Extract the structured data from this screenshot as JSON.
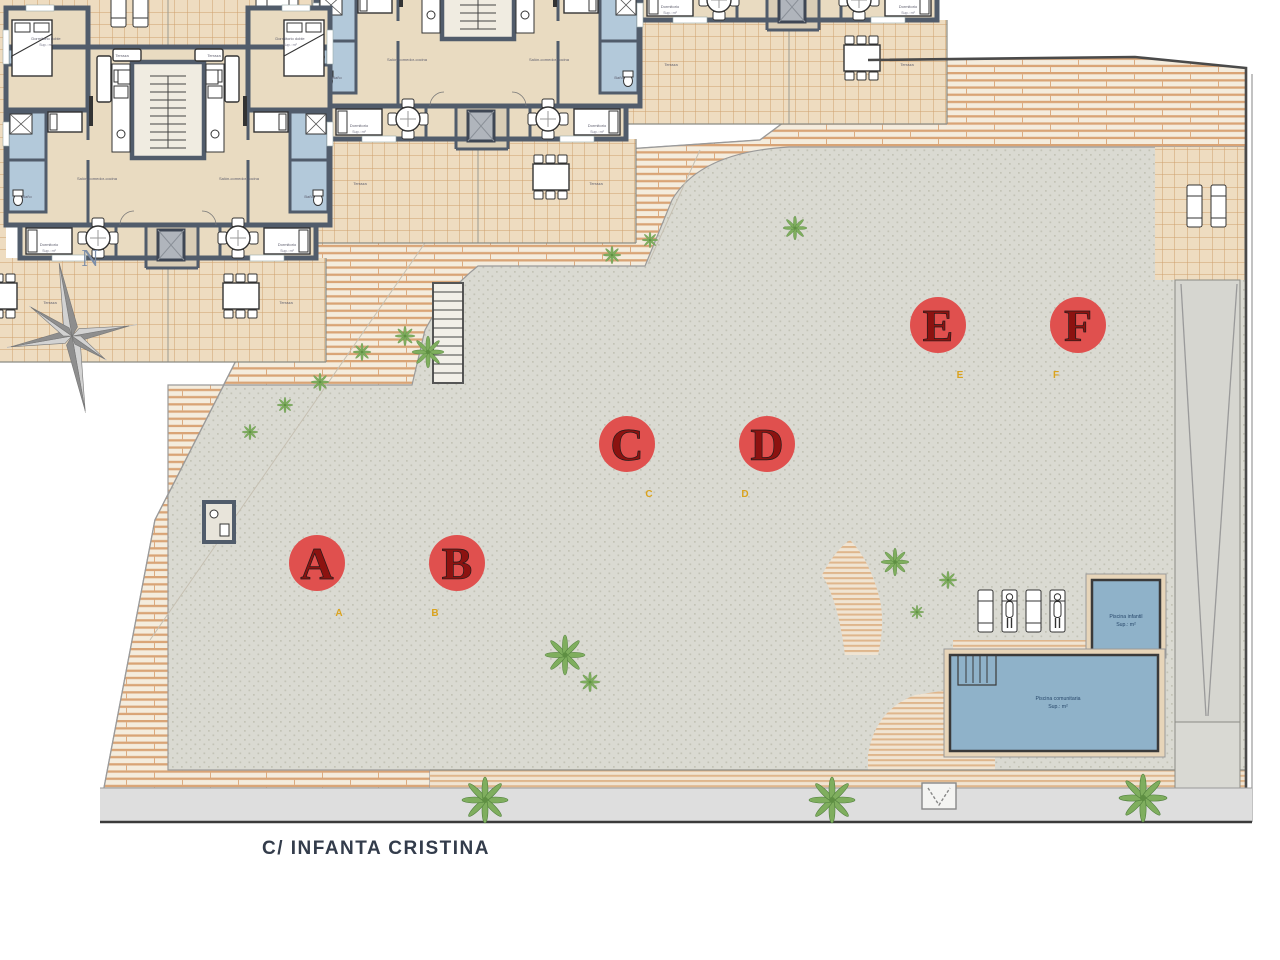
{
  "street_label": "C/ INFANTA CRISTINA",
  "compass_north": "N",
  "units": [
    {
      "letter": "A"
    },
    {
      "letter": "B"
    },
    {
      "letter": "C"
    },
    {
      "letter": "D"
    },
    {
      "letter": "E"
    },
    {
      "letter": "F"
    }
  ],
  "room_labels": {
    "dormitorio_doble": "Dormitorio doble",
    "dormitorio": "Dormitorio",
    "bano": "Baño",
    "terraza": "Terraza",
    "salon": "Salón-comedor-cocina",
    "sup": "Sup.: m²"
  },
  "pool_labels": {
    "infantil_line1": "Piscina infantil",
    "infantil_line2": "Sup.: m²",
    "comunitaria_line1": "Piscina comunitaria",
    "comunitaria_line2": "Sup.: m²"
  },
  "colors": {
    "badge_red": "#e0504e",
    "wall_slate": "#515c6b",
    "pool_blue": "#8fb2c9",
    "tile_line": "#cf9f6d",
    "hatch_line": "#d9a476"
  }
}
